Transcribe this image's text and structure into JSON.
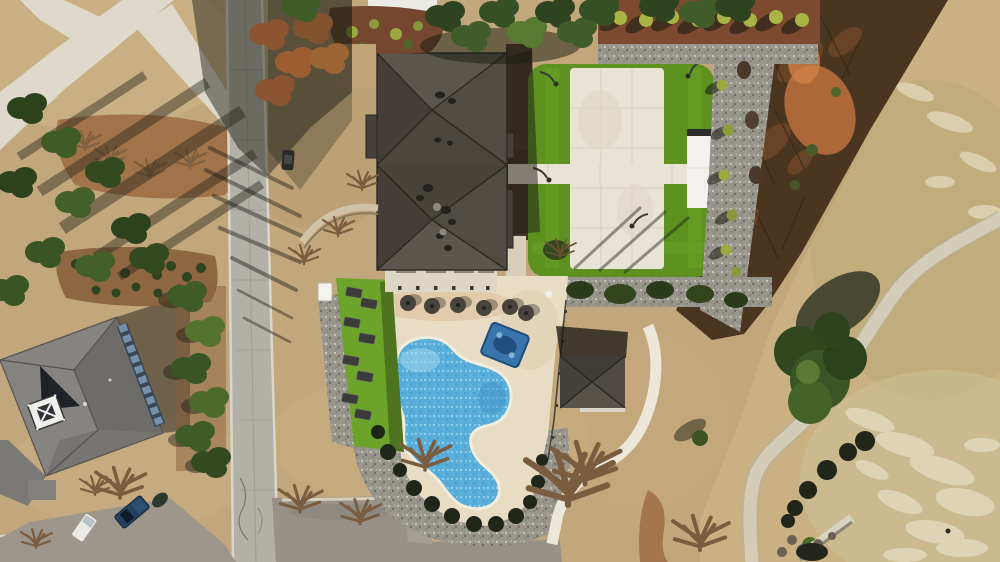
{
  "scene": {
    "type": "aerial-drone-photograph",
    "description": "Overhead drone view of a community clubhouse amenity center: large dark hip-roof clubhouse, free-form blue swimming pool with cream concrete deck, lounge chairs and umbrellas, artificial-turf event lawn with concrete pad and white pavilion, small pyramid-roof pool house with curved walkway, neighborhood street with parking lot, a large rotated gray-roof residence at lower left, and a dormant golf fairway with cart path at right.",
    "labels": {
      "clubhouse": "clubhouse with dark charcoal hip roof and rooftop vents",
      "pool": "free-form swimming pool with white coping",
      "splash_mat": "blue float mat on pool deck",
      "event_lawn": "artificial turf event lawn",
      "concrete_pad": "poured concrete event pad",
      "pavilion": "white flat-roof pavilion",
      "pool_house": "small hip-roof pool house",
      "residence": "rotated gray hip-roof house with cupola and skylight band",
      "street": "concrete neighborhood street with curbs",
      "parking": "asphalt parking lot with low wall",
      "fairway": "dormant golf fairway with frost patches",
      "cart_path": "curved concrete cart path",
      "brush": "leafless brown brush band",
      "tree_rows": "row of young ornamental trees in red mulch with gravel strip"
    },
    "counts": {
      "pool_umbrellas": 6,
      "lounge_chairs": 8,
      "young_trees_top_row": 8,
      "bushes_along_cart_path": 6
    },
    "vehicles": [
      "white pickup truck",
      "dark blue pickup truck",
      "dark car at curb"
    ]
  },
  "colors": {
    "ground": "#c2a77c",
    "fairway": "#c9b183",
    "brush": "#4a3520",
    "clay": "#c4763f",
    "road": "#b3b0a8",
    "asphalt": "#979187",
    "curb": "#dad6c8",
    "concrete": "#e9e3d6",
    "walk": "#ded9ca",
    "deck": "#e8ddc4",
    "pavilion": "#f2f1ed",
    "turf": "#5d9221",
    "turf_light": "#6ba428",
    "pool_water": "#58aed9",
    "pool_light": "#8fd0ec",
    "pool_deep": "#47a0cf",
    "coping": "#f2ecdc",
    "roof_base": "#4c4840",
    "roof_light": "#5a564d",
    "roof_dark": "#433f38",
    "house_roof": "#868481",
    "mulch": "#74472e",
    "gravel": "#98958d",
    "tree_green": "#3f5c26",
    "tree_dark": "#2c421d",
    "tree_lime": "#9aa83e",
    "tree_rust": "#8c5430",
    "skylight_blue": "#7590ab",
    "truck_navy": "#23405e",
    "vehicle_white": "#eceae4"
  }
}
